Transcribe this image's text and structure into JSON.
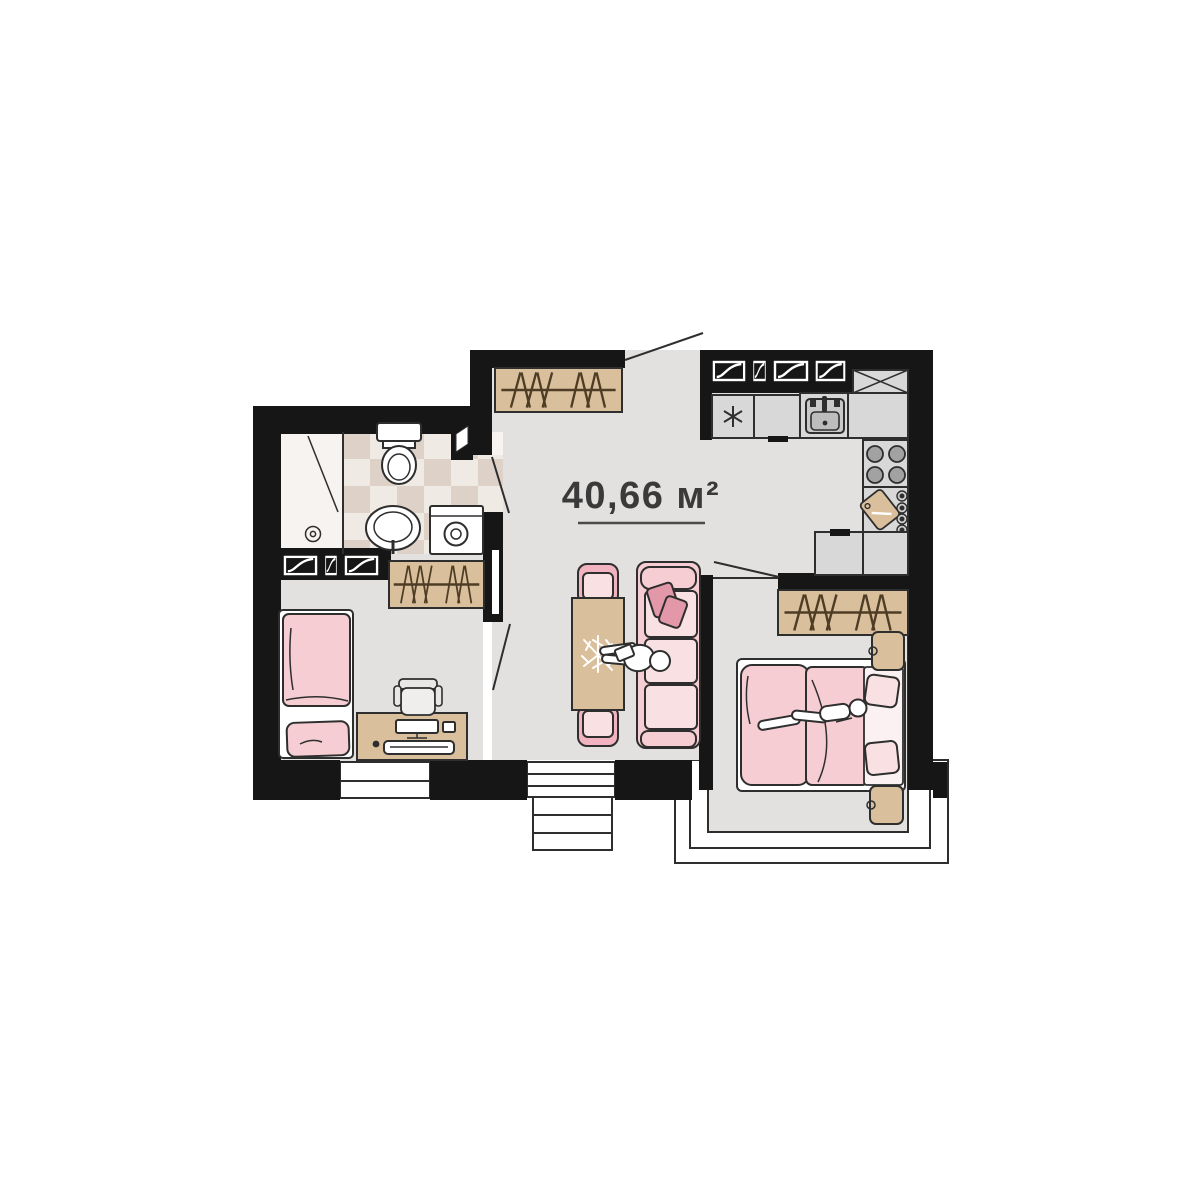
{
  "plan": {
    "area_label": "40,66 м²",
    "type_hint": "apartment-floor-plan"
  },
  "icons": {
    "freezer_symbol": "asterisk-icon",
    "vent_shaft": "crossed-box-icon",
    "windows": "window-icon",
    "stairs": "steps-icon"
  },
  "colors": {
    "wall": "#161616",
    "floor": "#e3e1df",
    "bathwhite": "#f6f3f0",
    "tileLight": "#f0eae4",
    "tileDark": "#ddd1c8",
    "kitchen": "#d8d8d8",
    "burner": "#a2a2a2",
    "wood": "#d9bf9c",
    "woodline": "#4e3d24",
    "pink": "#f1b3bf",
    "pinkLight": "#f5cdd3",
    "pinkSoft": "#f8e0e3",
    "pinkDark": "#e298a8",
    "line": "#2e2e2e",
    "label": "#3a3a3a"
  }
}
